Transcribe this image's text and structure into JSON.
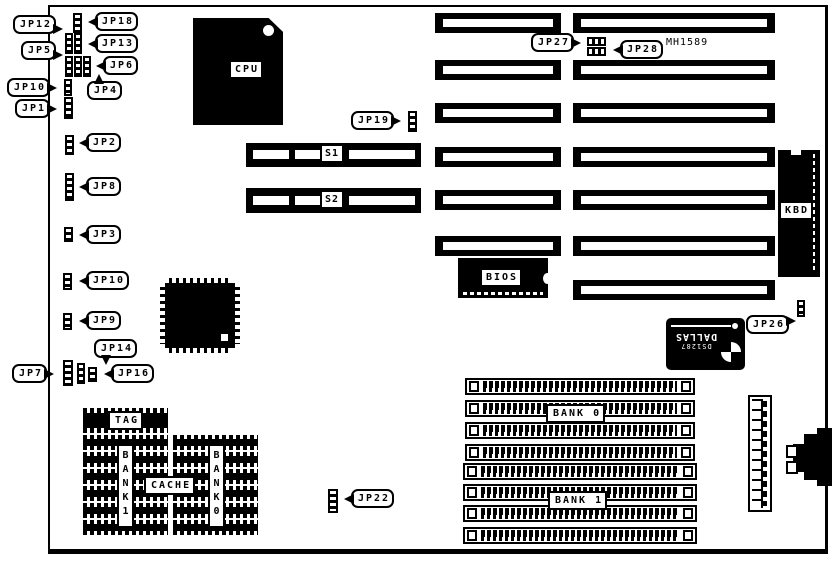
{
  "colors": {
    "ink": "#000000",
    "paper": "#ffffff"
  },
  "chips": {
    "cpu": "CPU",
    "bios": "BIOS",
    "kbd": "KBD",
    "mh1589": "MH1589",
    "dallas_model": "DS1287",
    "dallas_brand": "DALLAS",
    "s1": "S1",
    "s2": "S2"
  },
  "cache": {
    "tag": "TAG",
    "cache": "CACHE",
    "bank1_vertical": "BANK1",
    "bank0_vertical": "BANK0"
  },
  "memory": {
    "bank0": "BANK 0",
    "bank1": "BANK 1"
  },
  "callouts": {
    "jp1": "JP1",
    "jp2": "JP2",
    "jp3": "JP3",
    "jp4": "JP4",
    "jp5": "JP5",
    "jp6": "JP6",
    "jp7": "JP7",
    "jp8": "JP8",
    "jp9": "JP9",
    "jp10_top": "JP10",
    "jp10_mid": "JP10",
    "jp12": "JP12",
    "jp13": "JP13",
    "jp14": "JP14",
    "jp16": "JP16",
    "jp18": "JP18",
    "jp19": "JP19",
    "jp22": "JP22",
    "jp26": "JP26",
    "jp27": "JP27",
    "jp28": "JP28"
  }
}
